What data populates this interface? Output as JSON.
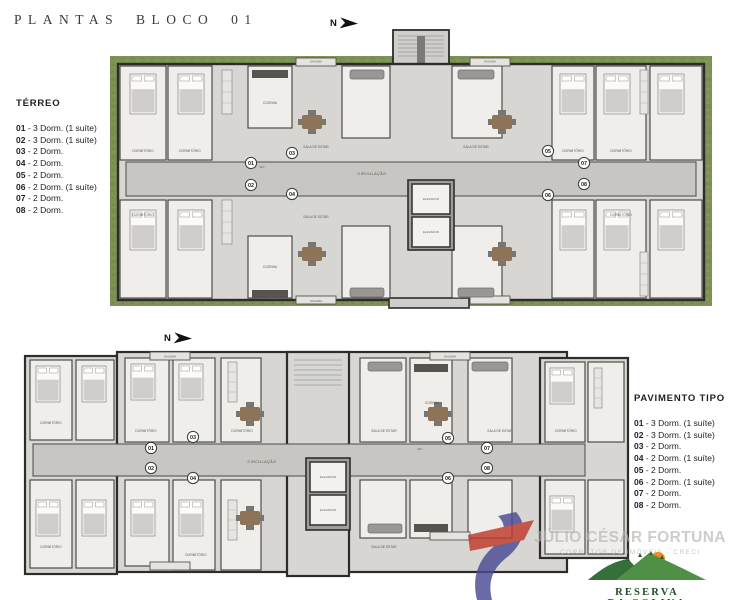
{
  "title": "PLANTAS BLOCO 01",
  "north": {
    "label": "N"
  },
  "legends": {
    "separator": " - ",
    "terreo": {
      "heading": "TÉRREO",
      "items": [
        {
          "num": "01",
          "desc": "3 Dorm. (1 suíte)"
        },
        {
          "num": "02",
          "desc": "3 Dorm. (1 suíte)"
        },
        {
          "num": "03",
          "desc": "2 Dorm."
        },
        {
          "num": "04",
          "desc": "2 Dorm."
        },
        {
          "num": "05",
          "desc": "2 Dorm."
        },
        {
          "num": "06",
          "desc": "2 Dorm. (1 suíte)"
        },
        {
          "num": "07",
          "desc": "2 Dorm."
        },
        {
          "num": "08",
          "desc": "2 Dorm."
        }
      ]
    },
    "pavimento_tipo": {
      "heading": "PAVIMENTO TIPO",
      "items": [
        {
          "num": "01",
          "desc": "3 Dorm. (1 suíte)"
        },
        {
          "num": "02",
          "desc": "3 Dorm. (1 suíte)"
        },
        {
          "num": "03",
          "desc": "2 Dorm."
        },
        {
          "num": "04",
          "desc": "2 Dorm. (1 suíte)"
        },
        {
          "num": "05",
          "desc": "2 Dorm."
        },
        {
          "num": "06",
          "desc": "2 Dorm. (1 suíte)"
        },
        {
          "num": "07",
          "desc": "2 Dorm."
        },
        {
          "num": "08",
          "desc": "2 Dorm."
        }
      ]
    }
  },
  "plans": {
    "unit_numbers": [
      "01",
      "02",
      "03",
      "04",
      "05",
      "06",
      "07",
      "08"
    ],
    "labels": {
      "circulacao": "CIRCULAÇÃO",
      "elevador": "ELEVADOR",
      "dormitorio": "DORMITÓRIO",
      "sala": "SALA DE ESTAR",
      "cozinha": "COZINHA",
      "sacada": "SACADA",
      "wc": "WC"
    }
  },
  "watermark": {
    "name": "JÚLIO CÉSAR FORTUNA",
    "subtitle": "CORRETOR DE IMÓVEIS - CRECI"
  },
  "brand": {
    "line1": "RESERVA",
    "line2": "DA COLINA",
    "line3": "RESIDENCIAL"
  },
  "colors": {
    "lawn": "#7d9254",
    "lawn_dark": "#6d8347",
    "lawn_light": "#8da263",
    "floor": "#d7d6d2",
    "corridor": "#c7c6c2",
    "core": "#9e9d99",
    "room": "#efeeea",
    "wall": "#2d2c2a",
    "wood": "#8d7358",
    "gray_furniture": "#989793",
    "dark_counter": "#55544f",
    "logo_blue": "#4a4a94",
    "logo_red": "#c0392b",
    "brand_green_dark": "#35703a",
    "brand_green_light": "#4f8f46",
    "brand_sun": "#f08c1e"
  }
}
